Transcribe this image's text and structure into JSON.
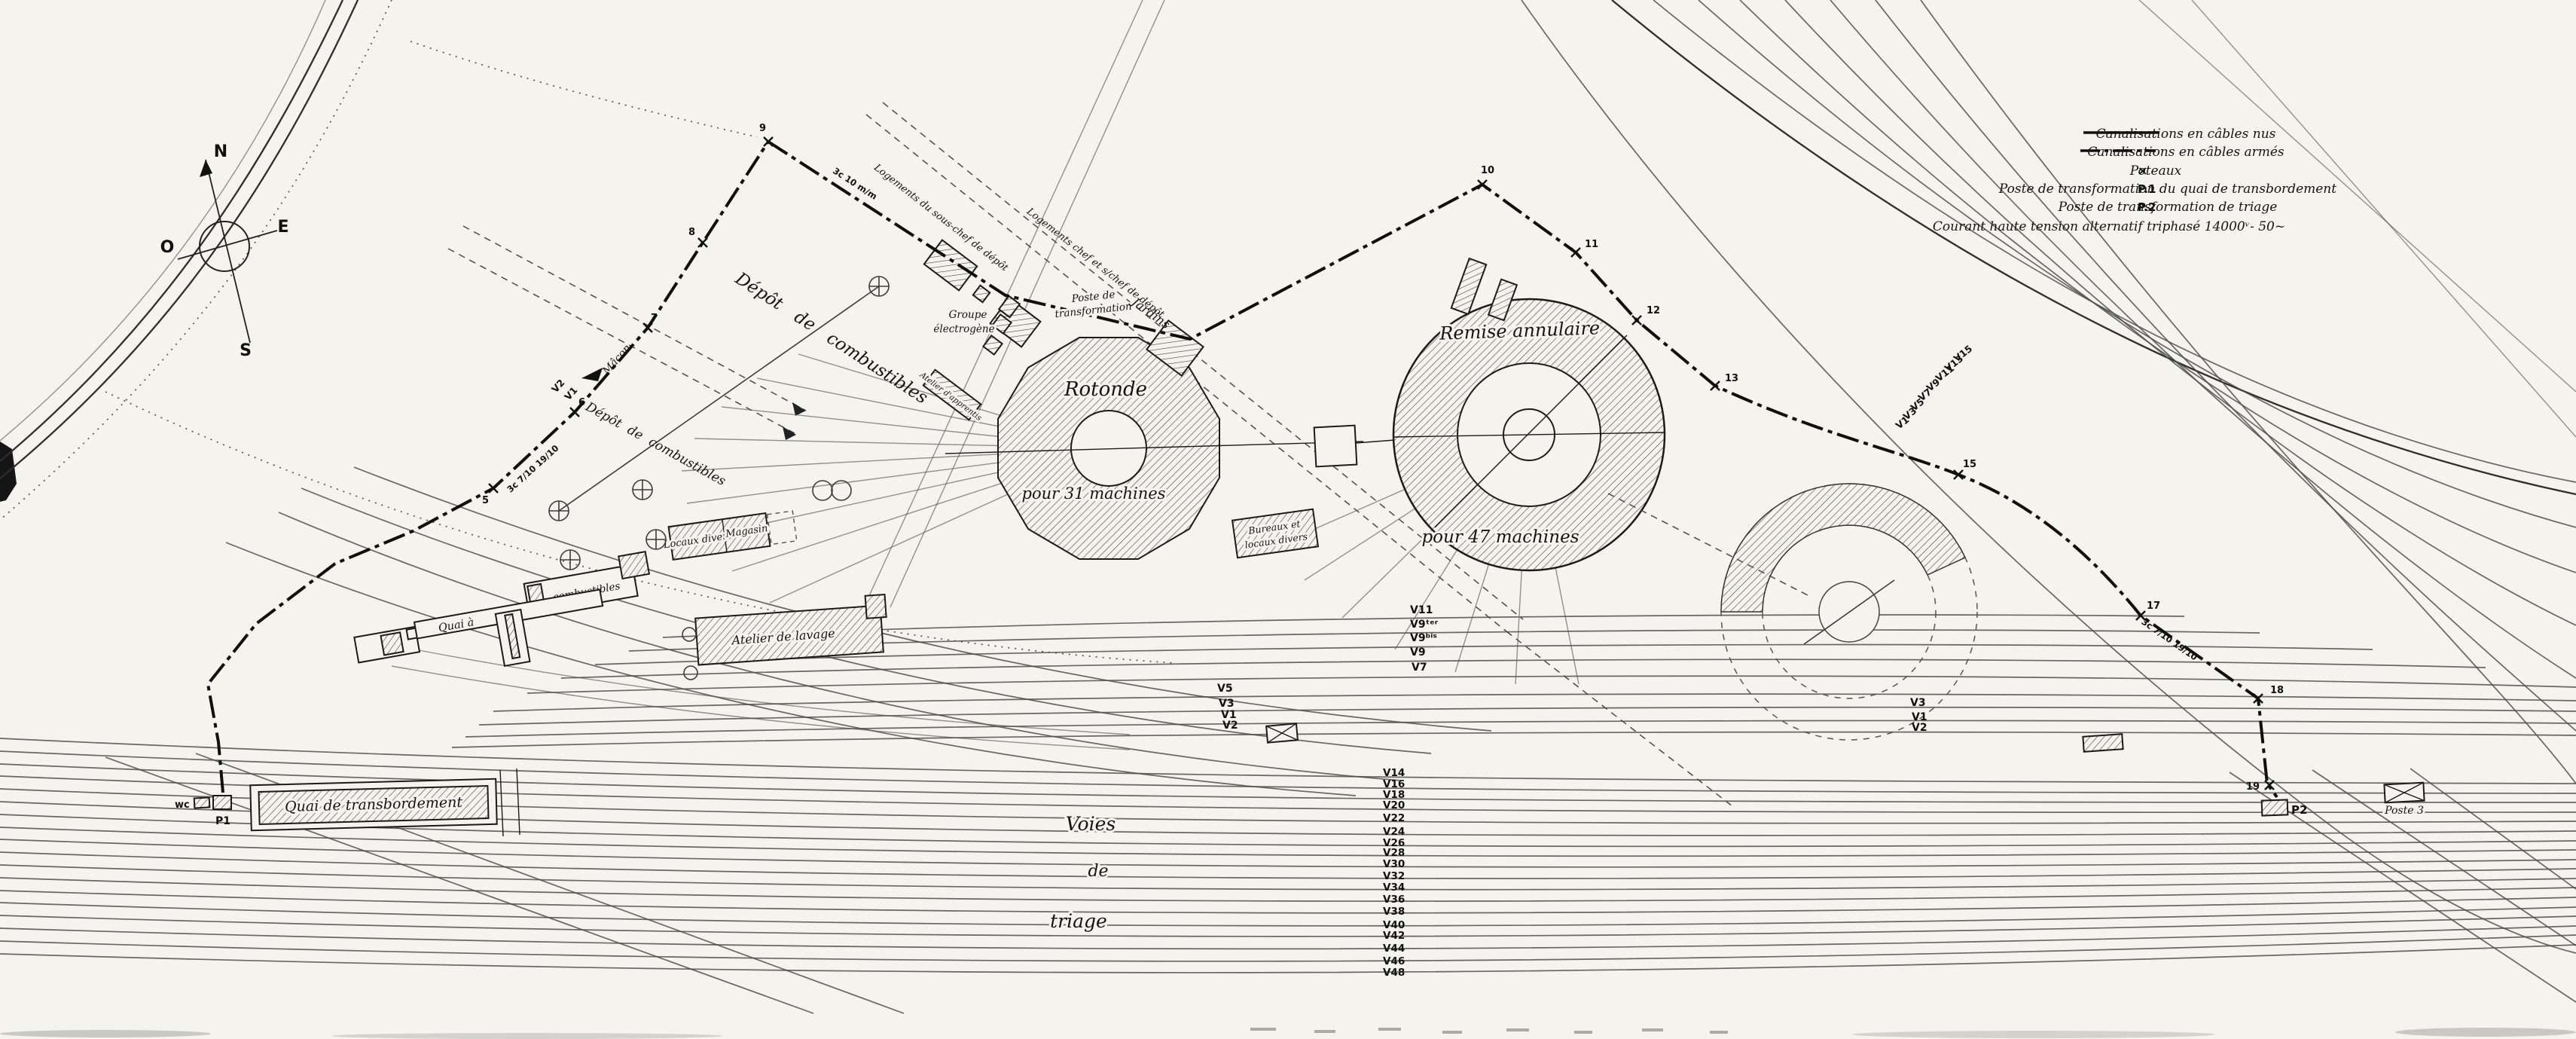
{
  "legend": {
    "items": [
      {
        "swatch": "solid",
        "symbol": "",
        "label": "Canalisations en câbles nus"
      },
      {
        "swatch": "dashed",
        "symbol": "",
        "label": "Canalisations en câbles armés"
      },
      {
        "swatch": "cross",
        "symbol": "×",
        "label": "Poteaux"
      },
      {
        "swatch": "text",
        "symbol": "P.1",
        "label": "Poste de transformation du quai de transbordement"
      },
      {
        "swatch": "text",
        "symbol": "P.2",
        "label": "Poste de transformation de triage"
      }
    ],
    "note": "Courant haute tension alternatif triphasé 14000ᵛ- 50~"
  },
  "compass": {
    "north": "N",
    "east": "E",
    "south": "S",
    "west": "O"
  },
  "facilities": {
    "rotonde_name": "Rotonde",
    "rotonde_capacity": "pour 31 machines",
    "remise_name": "Remise annulaire",
    "remise_capacity": "pour 47 machines",
    "depot_combustibles_upper": "Dépôt de combustibles",
    "depot_combustibles_lower": "Dépôt de combustibles",
    "groupe_electrogene_1": "Groupe",
    "groupe_electrogene_2": "électrogène",
    "poste_depot_1": "Poste de",
    "poste_depot_2": "transformation",
    "logements_sous_chef": "Logements du sous-chef de dépôt",
    "logements_chef": "Logements chef et s/chef de dépôt",
    "atelier_apprentis": "Atelier d'apprentis",
    "jardins": "Jardins",
    "macon": "Mâcon",
    "bureaux_1": "Bureaux et",
    "bureaux_2": "locaux divers",
    "locaux_divers": "Locaux divers",
    "magasin": "Magasin",
    "quai_a": "Quai à",
    "combustibles": "combustibles",
    "atelier_lavage": "Atelier de lavage",
    "quai_transbordement": "Quai de transbordement",
    "wc": "wc",
    "p1": "P1",
    "p2": "P2",
    "poste_3": "Poste 3",
    "voies_1": "Voies",
    "voies_2": "de",
    "voies_3": "triage"
  },
  "cables": {
    "spec_left": "3c 7/10 19/10",
    "spec_top": "3c 10 m/m",
    "spec_right": "3c 7/10 19/10"
  },
  "poles": [
    "5",
    "6",
    "7",
    "8",
    "9",
    "10",
    "11",
    "12",
    "13",
    "15",
    "17",
    "18",
    "19"
  ],
  "tracks": {
    "middle_left": [
      "V5",
      "V3",
      "V1",
      "V2"
    ],
    "middle_right": [
      "V11",
      "V9ᵗᵉʳ",
      "V9ᵇⁱˢ",
      "V9",
      "V7"
    ],
    "right": [
      "V3",
      "V1",
      "V2"
    ],
    "diagonal": [
      "V15",
      "V13",
      "V11",
      "V9",
      "V7",
      "V5",
      "V3",
      "V1"
    ],
    "sorting": [
      "V14",
      "V16",
      "V18",
      "V20",
      "V22",
      "V24",
      "V26",
      "V28",
      "V30",
      "V32",
      "V34",
      "V36",
      "V38",
      "V40",
      "V42",
      "V44",
      "V46",
      "V48"
    ]
  }
}
